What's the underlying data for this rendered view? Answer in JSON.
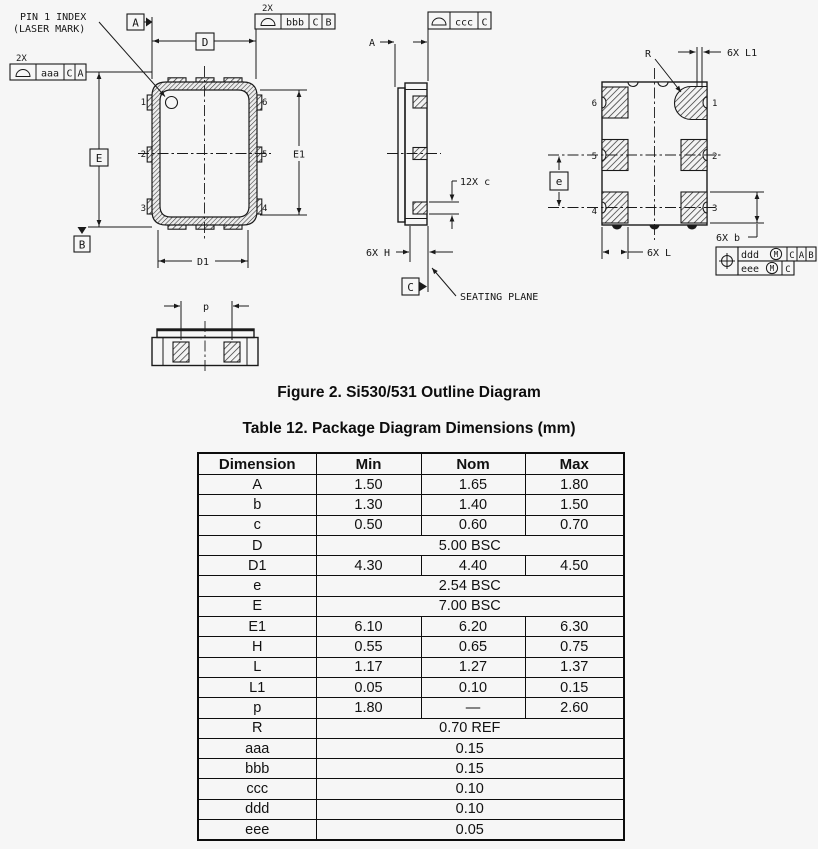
{
  "figure": {
    "caption": "Figure 2. Si530/531 Outline Diagram"
  },
  "table": {
    "caption": "Table 12. Package Diagram Dimensions (mm)",
    "columns": [
      "Dimension",
      "Min",
      "Nom",
      "Max"
    ],
    "rows": [
      {
        "dimension": "A",
        "min": "1.50",
        "nom": "1.65",
        "max": "1.80"
      },
      {
        "dimension": "b",
        "min": "1.30",
        "nom": "1.40",
        "max": "1.50"
      },
      {
        "dimension": "c",
        "min": "0.50",
        "nom": "0.60",
        "max": "0.70"
      },
      {
        "dimension": "D",
        "span": "5.00 BSC"
      },
      {
        "dimension": "D1",
        "min": "4.30",
        "nom": "4.40",
        "max": "4.50"
      },
      {
        "dimension": "e",
        "span": "2.54 BSC"
      },
      {
        "dimension": "E",
        "span": "7.00 BSC"
      },
      {
        "dimension": "E1",
        "min": "6.10",
        "nom": "6.20",
        "max": "6.30"
      },
      {
        "dimension": "H",
        "min": "0.55",
        "nom": "0.65",
        "max": "0.75"
      },
      {
        "dimension": "L",
        "min": "1.17",
        "nom": "1.27",
        "max": "1.37"
      },
      {
        "dimension": "L1",
        "min": "0.05",
        "nom": "0.10",
        "max": "0.15"
      },
      {
        "dimension": "p",
        "min": "1.80",
        "nom": "—",
        "max": "2.60"
      },
      {
        "dimension": "R",
        "span": "0.70 REF"
      },
      {
        "dimension": "aaa",
        "span": "0.15"
      },
      {
        "dimension": "bbb",
        "span": "0.15"
      },
      {
        "dimension": "ccc",
        "span": "0.10"
      },
      {
        "dimension": "ddd",
        "span": "0.10"
      },
      {
        "dimension": "eee",
        "span": "0.05"
      }
    ]
  },
  "diagram": {
    "top_view": {
      "note1": "PIN 1 INDEX",
      "note2": "(LASER MARK)",
      "pins": {
        "p1": "1",
        "p2": "2",
        "p3": "3",
        "p4": "4",
        "p5": "5",
        "p6": "6"
      },
      "dim_D": "D",
      "dim_D1": "D1",
      "dim_E": "E",
      "dim_E1": "E1",
      "datum_A": "A",
      "datum_B": "B"
    },
    "side_view": {
      "dim_A": "A",
      "dim_c": "12X c",
      "dim_H": "6X H",
      "datum_C": "C",
      "seating_plane": "SEATING PLANE"
    },
    "bottom_view": {
      "pins": {
        "p1": "1",
        "p2": "2",
        "p3": "3",
        "p4": "4",
        "p5": "5",
        "p6": "6"
      },
      "dim_R": "R",
      "dim_L1": "6X L1",
      "dim_e": "e",
      "dim_L": "6X L",
      "dim_b": "6X b"
    },
    "p_view": {
      "dim_p": "p"
    },
    "fcf": {
      "aaa": {
        "qty": "2X",
        "tol": "aaa",
        "d1": "C",
        "d2": "A"
      },
      "bbb": {
        "qty": "2X",
        "tol": "bbb",
        "d1": "C",
        "d2": "B"
      },
      "ccc": {
        "tol": "ccc",
        "d1": "C"
      },
      "position": {
        "row1": {
          "tol": "ddd",
          "mod": "M",
          "d1": "C",
          "d2": "A",
          "d3": "B"
        },
        "row2": {
          "tol": "eee",
          "mod": "M",
          "d1": "C"
        }
      }
    }
  }
}
